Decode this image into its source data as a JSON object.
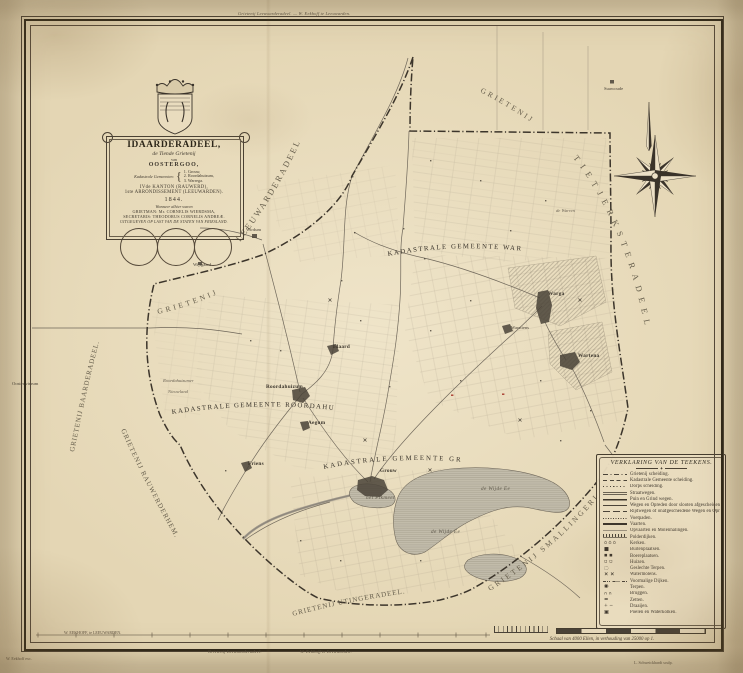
{
  "sheet": {
    "margin": {
      "top_note": "Grietenij Leeuwarderadeel. — W. Eekhoff te Leeuwarden.",
      "bottom_note_left": "Grietenij Leeuwarderadeel.",
      "bottom_note_right": "W. Eekhoff te Leeuwarden.",
      "publisher_inner": "W. EEKHOFF, te LEEUWARDEN.",
      "printer_outer_left": "W. Eekhoff exc.",
      "engraver_outer_right": "L. Schweickhardt sculp."
    },
    "scale_caption": "Schaal van 4000 Ellen, in verhouding van 25000 op 1."
  },
  "cartouche": {
    "title": "IDAARDERADEEL,",
    "subtitle": "de Tiende Grietenij",
    "of_word": "van",
    "region": "OOSTERGOO,",
    "cadastral_label": "Kadastrale Gemeenten:",
    "cadastral_munis": [
      "1. Grouw,",
      "2. Roordahuizum,",
      "3. Warrega."
    ],
    "kanton_line": "IVde KANTON (RAUWERD),",
    "arrondissement_line": "1ste ARRONDISSEMENT (LEEUWARDEN).",
    "year": "1844.",
    "officials_intro": "Wanneer alhier waren",
    "grietman_line": "GRIETMAN: Mr. CORNELIS WIERDSMA,",
    "secretaris_line": "SECRETARIS: THEODORUS CORNELIS ANDREÆ.",
    "issued_line": "UITGEGEVEN OP LAST VAN DE STATEN VAN FRIESLAND."
  },
  "legend": {
    "title": "VERKLARING VAN DE TEEKENS.",
    "items": [
      {
        "symbol": "line-dashdot",
        "label": "Grietenij scheiding."
      },
      {
        "symbol": "line-dash",
        "label": "Kadastrale Gemeente scheiding."
      },
      {
        "symbol": "line-dot",
        "label": "Dorps scheiding."
      },
      {
        "symbol": "line-double",
        "label": "Straatwegen."
      },
      {
        "symbol": "line-solid-bold",
        "label": "Puin en Grind wegen."
      },
      {
        "symbol": "line-solid",
        "label": "Wegen en Opreden door slooten afgescheiden."
      },
      {
        "symbol": "line-longdash",
        "label": "Rijdwegen of onafgescheidene Wegen en Opreden."
      },
      {
        "symbol": "line-dot-fine",
        "label": "Voetpaden."
      },
      {
        "symbol": "line-thick",
        "label": "Vaarten."
      },
      {
        "symbol": "line-thin",
        "label": "Opvaarten en Molenhalingen."
      },
      {
        "symbol": "line-hatch",
        "label": "Polderdijken."
      },
      {
        "symbol": "glyph-kerken",
        "label": "Kerken."
      },
      {
        "symbol": "glyph-buitenplaats",
        "label": "Buitenplaatsen."
      },
      {
        "symbol": "glyph-boereplaats",
        "label": "Boereplaatsen."
      },
      {
        "symbol": "glyph-huizen",
        "label": "Huizen."
      },
      {
        "symbol": "glyph-geslechte-terpen",
        "label": "Geslechte Terpen."
      },
      {
        "symbol": "glyph-watermolens",
        "label": "Watermolens."
      },
      {
        "symbol": "glyph-voormalige-dijken",
        "label": "Voormalige Dijken."
      },
      {
        "symbol": "glyph-terpen",
        "label": "Terpen."
      },
      {
        "symbol": "glyph-bruggen",
        "label": "Bruggen."
      },
      {
        "symbol": "glyph-zetten",
        "label": "Zetten."
      },
      {
        "symbol": "glyph-draaijen",
        "label": "Draaijen."
      },
      {
        "symbol": "glyph-waterkolken",
        "label": "Poelen en Waterkolken."
      }
    ]
  },
  "map": {
    "districts": [
      {
        "name": "KADASTRALE GEMEENTE WARREGA"
      },
      {
        "name": "KADASTRALE GEMEENTE ROORDAHUIZUM"
      },
      {
        "name": "KADASTRALE GEMEENTE GROUW"
      }
    ],
    "neighbors": [
      {
        "name": "GRIETENIJ"
      },
      {
        "name": "LEEUWARDERADEEL"
      },
      {
        "name": "GRIETENIJ"
      },
      {
        "name": "TIETJERKSTERADEEL"
      },
      {
        "name": "GRIETENIJ SMALLINGERLAND."
      },
      {
        "name": "GRIETENIJ UTINGERADEEL."
      },
      {
        "name": "GRIETENIJ RAUWERDERHEM."
      },
      {
        "name": "GRIETENIJ BAARDERADEEL."
      }
    ],
    "places": [
      {
        "name": "Wijtgaard"
      },
      {
        "name": "Wirdum"
      },
      {
        "name": "Oosterwierum"
      },
      {
        "name": "Roordahuizumer"
      },
      {
        "name": "Nieuwland"
      },
      {
        "name": "Roordahuizum"
      },
      {
        "name": "Idaard"
      },
      {
        "name": "Aegum"
      },
      {
        "name": "Friens"
      },
      {
        "name": "Grouw"
      },
      {
        "name": "Warga"
      },
      {
        "name": "Warstiens"
      },
      {
        "name": "Wartena"
      },
      {
        "name": "de Warren"
      },
      {
        "name": "Suawoude"
      },
      {
        "name": "het Pikmeer"
      },
      {
        "name": "de Wijde Ee"
      },
      {
        "name": "de Wijde Ee"
      }
    ]
  },
  "colors": {
    "paper": "#e4d6b4",
    "ink": "#3f382e",
    "water": "#b9b3a2",
    "accent_red": "#a83a2e"
  }
}
